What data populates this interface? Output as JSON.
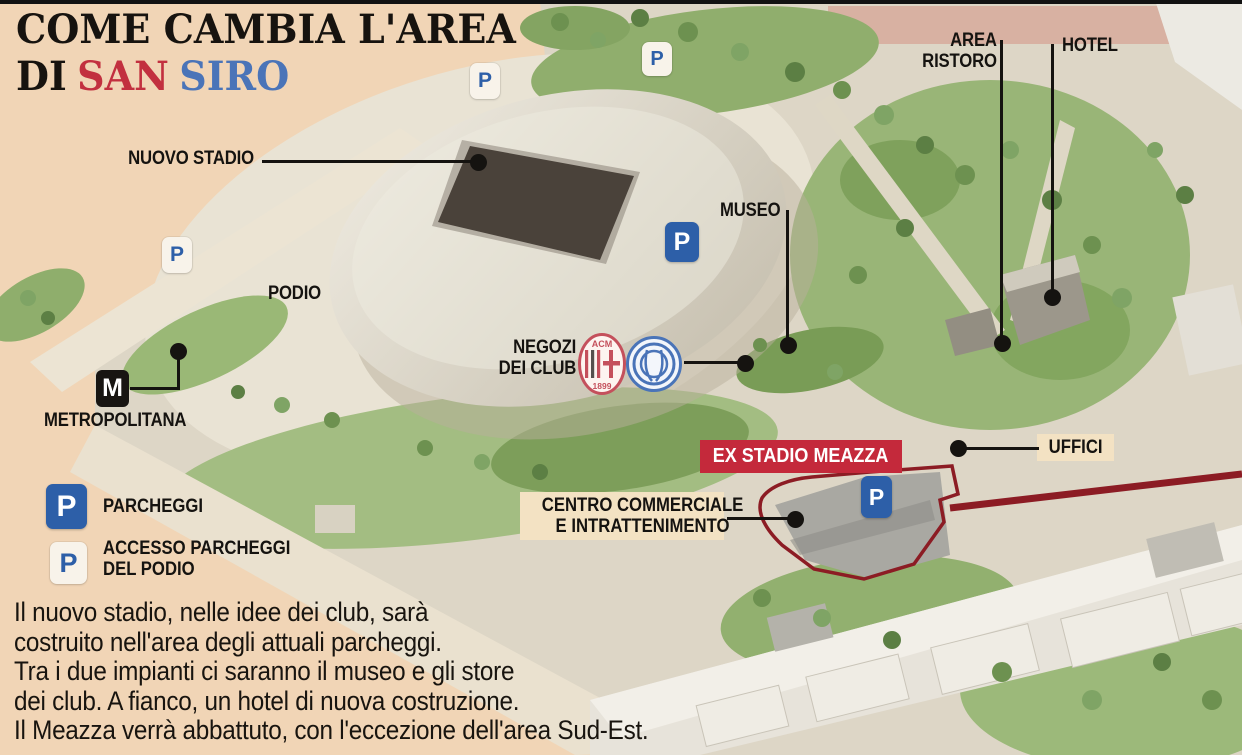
{
  "title": {
    "line1": "COME CAMBIA L'AREA",
    "line2_prefix": "DI",
    "line2_red": "SAN",
    "line2_blue": "SIRO"
  },
  "theme": {
    "background": "#f1d5b6",
    "title_red": "#c2303f",
    "title_blue": "#4a74b8",
    "banner_red": "#c4293b",
    "meazza_outline_red": "#8c1c24",
    "parking_blue": "#2d5fa8",
    "label_cream": "#f3e2c3",
    "ink": "#141210"
  },
  "map_labels": {
    "nuovo_stadio": "NUOVO STADIO",
    "podio": "PODIO",
    "museo": "MUSEO",
    "negozi_line1": "NEGOZI",
    "negozi_line2": "DEI CLUB",
    "area_ristoro_line1": "AREA",
    "area_ristoro_line2": "RISTORO",
    "hotel": "HOTEL",
    "uffici": "UFFICI",
    "ex_stadio_meazza": "EX STADIO MEAZZA",
    "centro_line1": "CENTRO COMMERCIALE",
    "centro_line2": "E INTRATTENIMENTO",
    "metropolitana": "METROPOLITANA"
  },
  "icons": {
    "parking_letter": "P",
    "metro_letter": "M"
  },
  "club_badges": {
    "milan_top": "ACM",
    "milan_bottom": "1899"
  },
  "legend": {
    "parcheggi": "PARCHEGGI",
    "accesso_line1": "ACCESSO PARCHEGGI",
    "accesso_line2": "DEL PODIO"
  },
  "description_lines": [
    "Il nuovo stadio, nelle idee dei club, sarà",
    "costruito nell'area degli attuali parcheggi.",
    "Tra i due impianti ci saranno il museo e gli store",
    "dei club. A fianco, un hotel di nuova costruzione.",
    "Il Meazza verrà abbattuto, con l'eccezione dell'area Sud-Est."
  ]
}
